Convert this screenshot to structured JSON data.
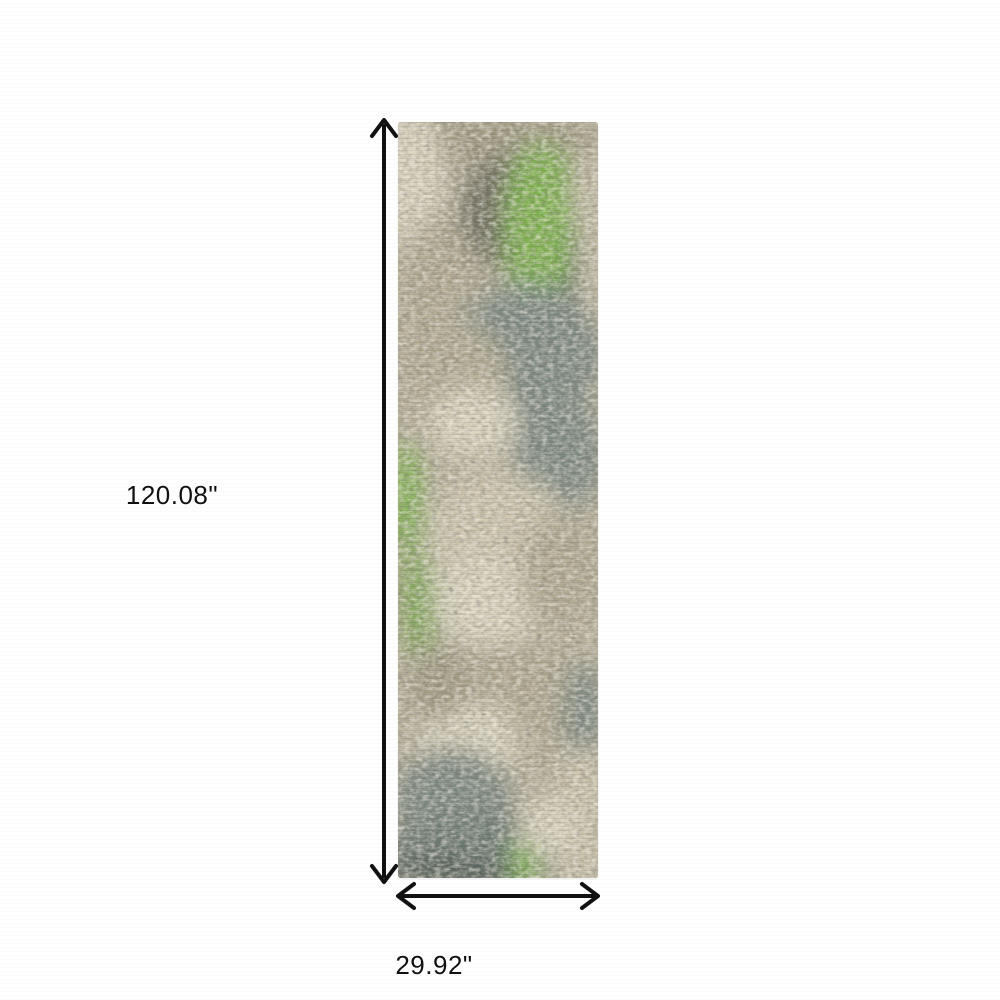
{
  "diagram": {
    "height_label": "120.08\"",
    "width_label": "29.92\"",
    "arrow_color": "#111111"
  },
  "rug": {
    "description": "abstract distressed runner rug in beige, grey, slate blue and green",
    "palette": {
      "base": "#b9b09a",
      "cream": "#ddd5bf",
      "beige": "#cfc6ae",
      "taupe": "#b1a890",
      "tan": "#a29a81",
      "olive": "#6f6d5d",
      "dark_olive": "#5e6659",
      "slate": "#7a8780",
      "mid_slate": "#6d7a75",
      "dark_slate": "#505b55",
      "green": "#7cb34a",
      "muted_green": "#7fa851",
      "dark_green": "#5e7a3a"
    }
  }
}
